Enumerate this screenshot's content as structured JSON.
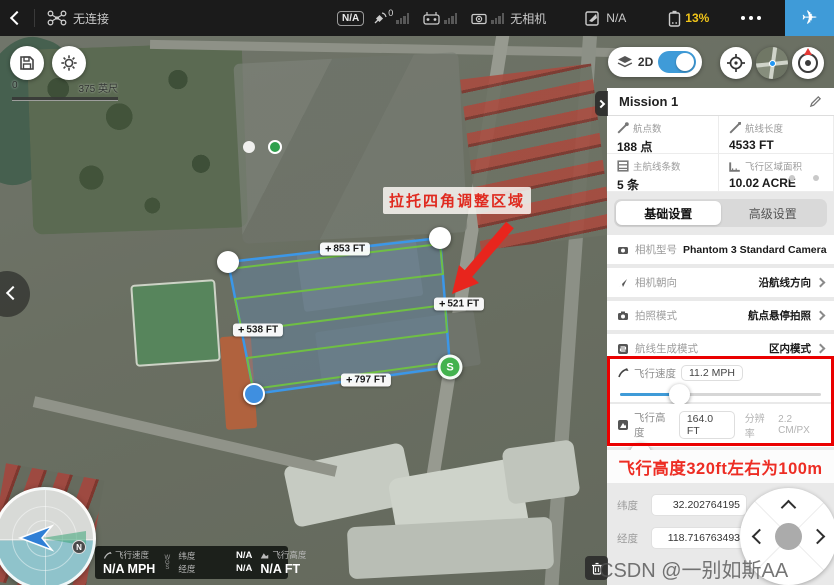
{
  "topbar": {
    "connection": "无连接",
    "na_badge": "N/A",
    "gps_count": "0",
    "no_camera": "无相机",
    "mission_status": "N/A",
    "battery": "13%"
  },
  "map": {
    "scale_start": "0",
    "scale_end": "375 英尺",
    "mode_label": "2D",
    "annotation": "拉托四角调整区域",
    "plus": "+",
    "edge_top": "853 FT",
    "edge_right": "521 FT",
    "edge_left": "538 FT",
    "edge_bottom": "797 FT",
    "start_label": "S"
  },
  "panel": {
    "title": "Mission 1",
    "stats": [
      {
        "label": "航点数",
        "value": "188 点"
      },
      {
        "label": "航线长度",
        "value": "4533 FT"
      },
      {
        "label": "主航线条数",
        "value": "5 条"
      },
      {
        "label": "飞行区域面积",
        "value": "10.02 ACRE"
      }
    ],
    "tabs": [
      {
        "label": "基础设置"
      },
      {
        "label": "高级设置"
      }
    ],
    "rows": [
      {
        "label": "相机型号",
        "value": "Phantom 3 Standard Camera"
      },
      {
        "label": "相机朝向",
        "value": "沿航线方向"
      },
      {
        "label": "拍照模式",
        "value": "航点悬停拍照"
      },
      {
        "label": "航线生成模式",
        "value": "区内模式"
      }
    ],
    "speed": {
      "label": "飞行速度",
      "value": "11.2 MPH",
      "percent": 30
    },
    "altitude": {
      "label": "飞行高度",
      "value": "164.0 FT",
      "res_label": "分辨率",
      "res_value": "2.2 CM/PX",
      "percent": 11
    },
    "note": "飞行高度320ft左右为100m",
    "coords": [
      {
        "label": "纬度",
        "value": "32.202764195"
      },
      {
        "label": "经度",
        "value": "118.716763493"
      }
    ]
  },
  "statusbar": {
    "speed_label": "飞行速度",
    "speed_value": "N/A MPH",
    "wgs": "WGS",
    "lat_label": "纬度",
    "lat_value": "N/A",
    "lng_label": "经度",
    "lng_value": "N/A",
    "alt_label": "飞行高度",
    "alt_value": "N/A FT"
  },
  "compass": {
    "north": "N"
  },
  "watermark": "CSDN @一别如斯AA",
  "colors": {
    "accent_blue": "#3f9bd8",
    "warning_yellow": "#f0c419",
    "alert_red": "#ea0000",
    "annotation_red": "#e02a1f",
    "path_green": "#6fbf44",
    "polygon_blue": "#3b97e8",
    "start_green": "#43b24e"
  }
}
